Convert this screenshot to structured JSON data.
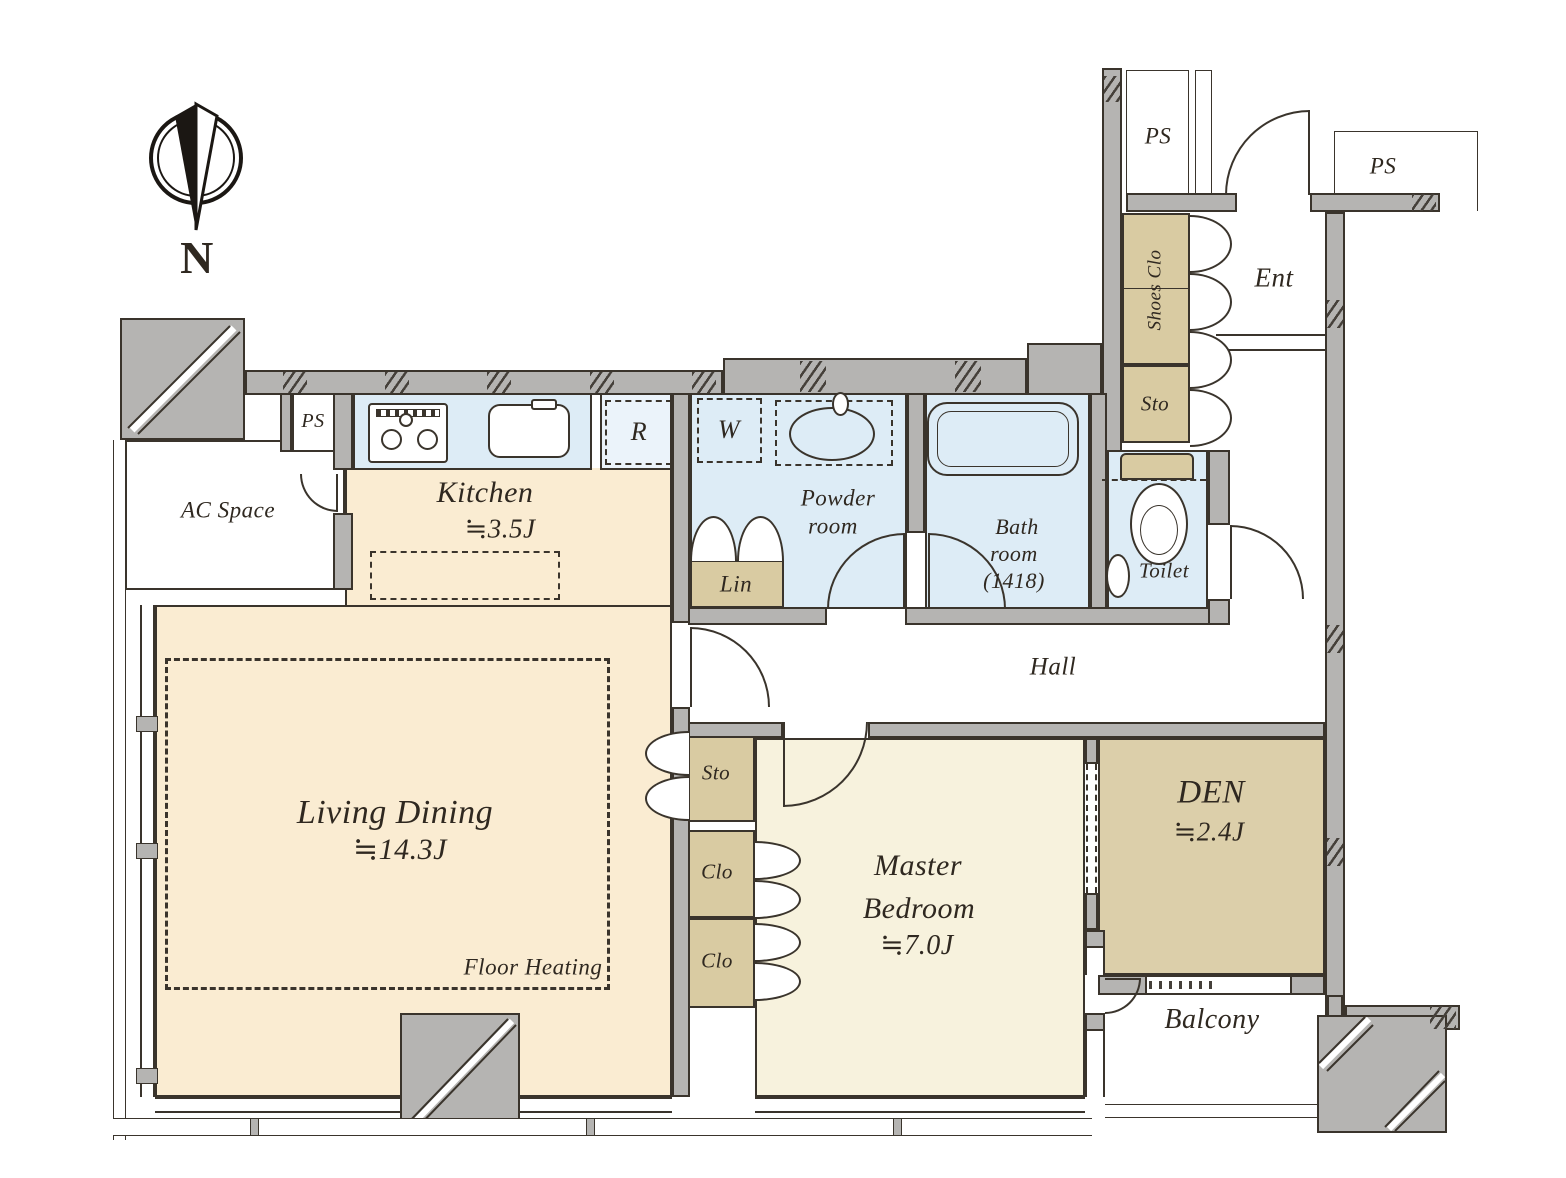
{
  "compass": {
    "north_label": "N"
  },
  "shafts": {
    "ps_top": "PS",
    "ps_outside": "PS",
    "ps_kitchen": "PS"
  },
  "entrance": {
    "label": "Ent",
    "shoes_closet": "Shoes Clo",
    "storage": "Sto"
  },
  "rooms": {
    "ac_space": {
      "name": "AC Space"
    },
    "kitchen": {
      "name": "Kitchen",
      "area": "≒3.5J",
      "fridge": "R"
    },
    "powder_room": {
      "name_line1": "Powder",
      "name_line2": "room",
      "washer": "W",
      "linen": "Lin"
    },
    "bathroom": {
      "name_line1": "Bath",
      "name_line2": "room",
      "size": "(1418)"
    },
    "toilet": {
      "name": "Toilet"
    },
    "hall": {
      "name": "Hall"
    },
    "living_dining": {
      "name": "Living Dining",
      "area": "≒14.3J",
      "floor_heating": "Floor Heating"
    },
    "master_bedroom": {
      "name_line1": "Master",
      "name_line2": "Bedroom",
      "area": "≒7.0J",
      "storage": "Sto",
      "closet1": "Clo",
      "closet2": "Clo"
    },
    "den": {
      "name": "DEN",
      "area": "≒2.4J"
    },
    "balcony": {
      "name": "Balcony"
    }
  },
  "colors": {
    "wall": "#b5b4b2",
    "outline": "#3a342c",
    "ink": "#2f2820",
    "floor_living": "#faecd2",
    "floor_bedroom": "#f7f2dd",
    "floor_wet": "#ddecf6",
    "floor_fridge_nook": "#ebf3fa",
    "closet": "#d9cba2",
    "den_floor": "#dccfaa"
  }
}
